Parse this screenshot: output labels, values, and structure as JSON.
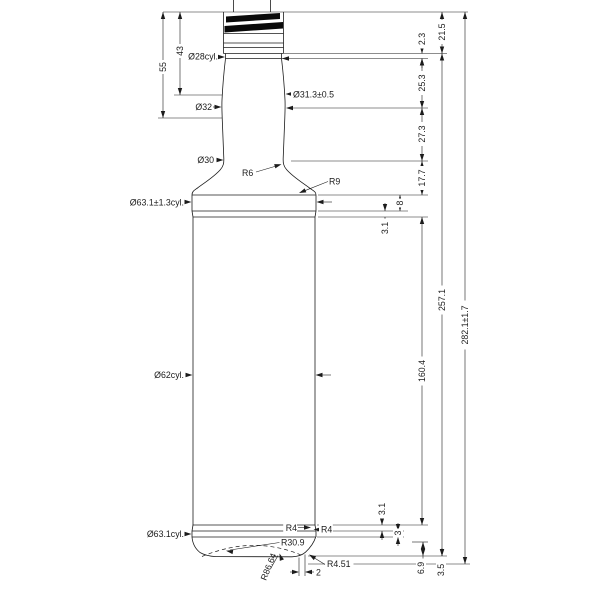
{
  "drawing": {
    "type": "engineering bottle drawing",
    "labels": {
      "d55": "55",
      "d43": "43",
      "d28": "Ø28cyl.",
      "d313": "Ø31.3±0.5",
      "d32": "Ø32",
      "d30": "Ø30",
      "r6": "R6",
      "r9": "R9",
      "d631t": "Ø63.1±1.3cyl.",
      "d62": "Ø62cyl.",
      "d631b": "Ø63.1cyl.",
      "r4l": "R4",
      "r4r": "R4",
      "r309": "R30.9",
      "r8664": "R86.64",
      "r451": "R4.51",
      "w2": "2",
      "d23": "2.3",
      "d215": "21.5",
      "d253": "25.3",
      "d273": "27.3",
      "d177": "17.7",
      "d8": "8",
      "d31t": "3.1",
      "d1604": "160.4",
      "d2571": "257.1",
      "d2821": "282.1±1.7",
      "d31b": "3.1",
      "d3": "3",
      "d69": "6.9",
      "d35": "3.5"
    },
    "line_color": "#1c1c1c",
    "background": "#ffffff"
  }
}
